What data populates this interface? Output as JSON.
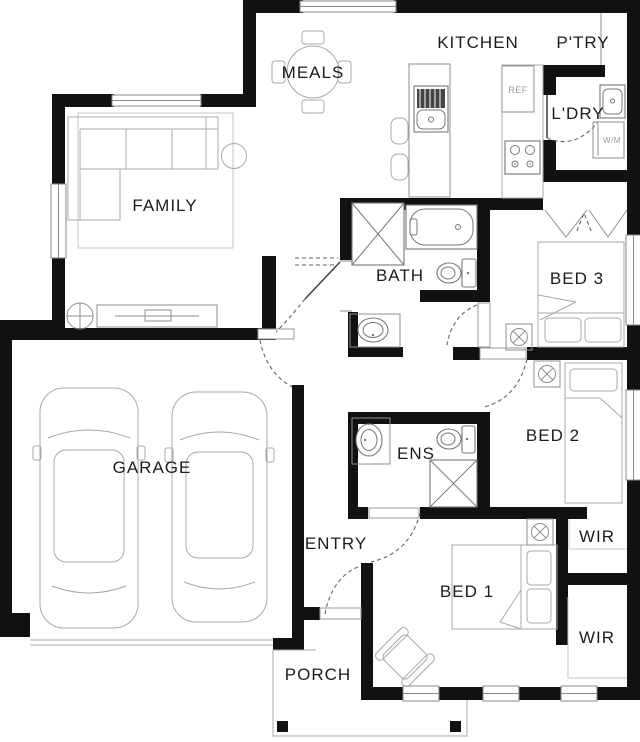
{
  "plan_title": "Single storey house floor plan",
  "rooms": {
    "meals": {
      "label": "MEALS"
    },
    "kitchen": {
      "label": "KITCHEN"
    },
    "pantry": {
      "label": "P'TRY"
    },
    "laundry": {
      "label": "L'DRY"
    },
    "family": {
      "label": "FAMILY"
    },
    "bath": {
      "label": "BATH"
    },
    "bed3": {
      "label": "BED 3"
    },
    "bed2": {
      "label": "BED 2"
    },
    "garage": {
      "label": "GARAGE"
    },
    "ens": {
      "label": "ENS"
    },
    "entry": {
      "label": "ENTRY"
    },
    "wir_upper": {
      "label": "WIR"
    },
    "bed1": {
      "label": "BED 1"
    },
    "wir_lower": {
      "label": "WIR"
    },
    "porch": {
      "label": "PORCH"
    }
  },
  "appliances": {
    "fridge_label": "REF",
    "washer_label": "W/M"
  },
  "colors": {
    "wall": "#111111",
    "furniture_line": "#a8a8a8",
    "fixture_line": "#777777",
    "label_text": "#1c1c1c",
    "muted_label": "#9a9a9a",
    "background": "#ffffff"
  },
  "fixtures": [
    "sofa",
    "rug",
    "side-table",
    "tv-unit",
    "ceiling-fan",
    "dining-table",
    "kitchen-island",
    "island-sink",
    "bar-stools",
    "fridge",
    "cooktop",
    "laundry-trough",
    "washing-machine",
    "bathtub",
    "shower",
    "toilet",
    "vanity-basin",
    "double-bed",
    "single-bed",
    "bifold-robe-doors",
    "car",
    "armchair",
    "porch-post",
    "robe-light-symbol"
  ]
}
